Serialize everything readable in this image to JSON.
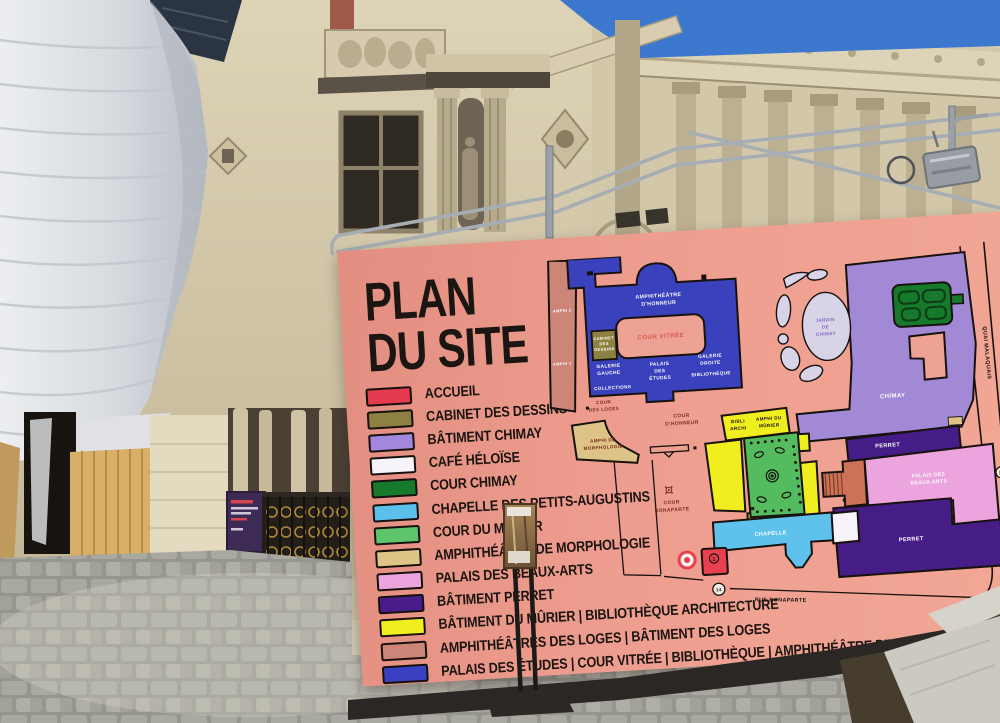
{
  "sign": {
    "title": [
      "PLAN",
      "DU SITE"
    ],
    "legend": [
      {
        "label": "ACCUEIL",
        "color": "#e63b4e"
      },
      {
        "label": "CABINET DES DESSINS",
        "color": "#8d8040"
      },
      {
        "label": "BÂTIMENT CHIMAY",
        "color": "#a287dd"
      },
      {
        "label": "CAFÉ HÉLOÏSE",
        "color": "#f6f3fa"
      },
      {
        "label": "COUR CHIMAY",
        "color": "#17792c"
      },
      {
        "label": "CHAPELLE DES PETITS-AUGUSTINS",
        "color": "#5cc1ea"
      },
      {
        "label": "COUR DU MÛRIER",
        "color": "#5ec56d"
      },
      {
        "label": "AMPHITHÉÂTRE DE MORPHOLOGIE",
        "color": "#dfc487"
      },
      {
        "label": "PALAIS DES BEAUX-ARTS",
        "color": "#eca4de"
      },
      {
        "label": "BÂTIMENT PERRET",
        "color": "#481d8b"
      },
      {
        "label": "BÂTIMENT DU MÛRIER | BIBLIOTHÈQUE ARCHITECTURE",
        "color": "#f1ee20"
      },
      {
        "label": "AMPHITHÉÂTRES DES LOGES | BÂTIMENT DES LOGES",
        "color": "#cd8578"
      },
      {
        "label": "PALAIS DES ÉTUDES | COUR VITRÉE | BIBLIOTHÈQUE | AMPHITHÉÂTRE D'HONNEUR",
        "color": "#3a40c2"
      }
    ],
    "map": {
      "amphi2": "AMPHI 2",
      "amphi1": "AMPHI 1",
      "amph_honneur": [
        "AMPHITHÉÂTRE",
        "D'HONNEUR"
      ],
      "cour_vitree": "COUR VITRÉE",
      "cabinet": [
        "CABINET",
        "DES",
        "DESSINS"
      ],
      "galerie_gauche": [
        "GALERIE",
        "GAUCHE"
      ],
      "collections": "COLLECTIONS",
      "palais_etudes": [
        "PALAIS",
        "DES",
        "ÉTUDES"
      ],
      "galerie_droite": [
        "GALERIE",
        "DROITE",
        "BIBLIOTHÈQUE"
      ],
      "cour_loges": [
        "COUR",
        "DES LOGES"
      ],
      "morphologie": [
        "AMPHI DE",
        "MORPHOLOGIE"
      ],
      "cour_honneur": [
        "COUR",
        "D'HONNEUR"
      ],
      "bibli": [
        "BIBLI",
        "ARCHI"
      ],
      "amphi_murier": [
        "AMPHI DU",
        "MÛRIER"
      ],
      "cour_bonaparte": [
        "COUR",
        "BONAPARTE"
      ],
      "chapelle": "CHAPELLE",
      "perret": "PERRET",
      "beaux_arts": [
        "PALAIS DES",
        "BEAUX-ARTS"
      ],
      "chimay": "CHIMAY",
      "jardin": [
        "JARDIN",
        "DE",
        "CHIMAY"
      ],
      "quai": "QUAI MALAQUAIS",
      "rue": "RUE BONAPARTE",
      "markers": {
        "accueil": "1",
        "quai": "13",
        "rue": "14"
      }
    },
    "colors": {
      "board": "#ee9e90",
      "outline": "#17120e",
      "palais_blue": "#3a41bd"
    }
  }
}
